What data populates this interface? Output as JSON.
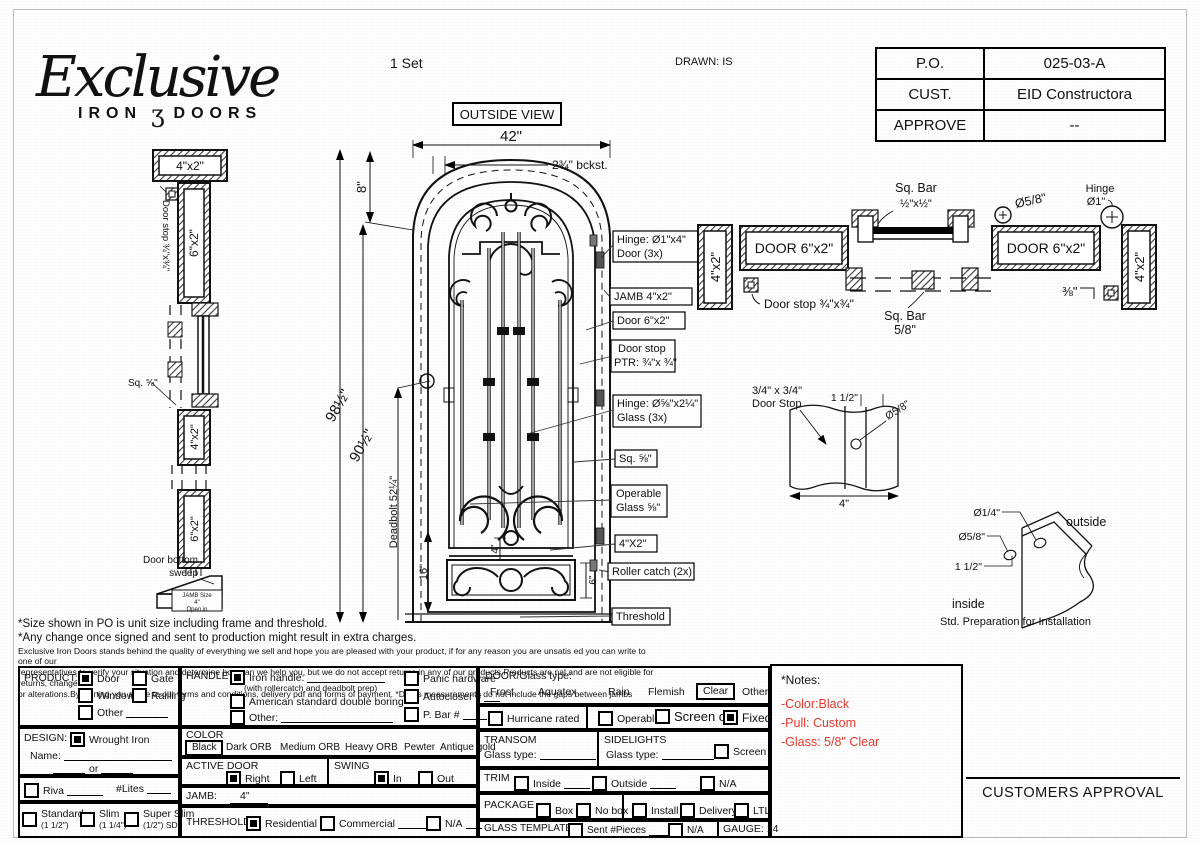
{
  "colors": {
    "accent_red": "#e8392e",
    "ink": "#111111"
  },
  "header": {
    "logo_script": "Exclusive",
    "logo_iron": "IRON",
    "logo_scroll": "ʒ",
    "logo_doors": "DOORS",
    "set_count": "1 Set",
    "drawn": "DRAWN: IS",
    "po_table": {
      "rows": [
        {
          "label": "P.O.",
          "value": "025-03-A"
        },
        {
          "label": "CUST.",
          "value": "EID Constructora"
        },
        {
          "label": "APPROVE",
          "value": "--"
        }
      ]
    }
  },
  "elevation": {
    "title": "OUTSIDE VIEW",
    "dim_width": "42\"",
    "dim_backset": "2¾\" bckst.",
    "dim_arch": "8\"",
    "dim_total": "98½\"",
    "dim_door": "90½\"",
    "dim_deadbolt": "Deadbolt 52¼\"",
    "dim_bottom": "16\"",
    "dim_gap": "4\"",
    "dim_panel": "6\"",
    "callouts": [
      {
        "l1": "Hinge: Ø1\"x4\"",
        "l2": "Door (3x)"
      },
      {
        "l1": "JAMB  4\"x2\"",
        "l2": ""
      },
      {
        "l1": "Door 6\"x2\"",
        "l2": ""
      },
      {
        "l1": "Door stop",
        "l2": "PTR: ¾\"x ¾\""
      },
      {
        "l1": "Hinge: Ø⅝\"x2¼\"",
        "l2": "Glass (3x)"
      },
      {
        "l1": "Sq. ⅝\"",
        "l2": ""
      },
      {
        "l1": "Operable",
        "l2": "Glass ⅝\""
      },
      {
        "l1": "4\"X2\"",
        "l2": ""
      },
      {
        "l1": "Roller catch  (2x)",
        "l2": ""
      },
      {
        "l1": "Threshold",
        "l2": ""
      }
    ]
  },
  "side_profile": {
    "top_box": "4\"x2\"",
    "door_stop": "Door stop ¾\"x¾\"",
    "upper_box": "6\"x2\"",
    "sq": "Sq. ⅝\"",
    "mid_box": "4\"x2\"",
    "lower_box": "6\"x2\"",
    "sweep1": "Door bottom",
    "sweep2": "sweep",
    "jamb1": "JAMB Size",
    "jamb2": "4\"",
    "jamb3": "Open in"
  },
  "plan": {
    "sqbar_top1": "Sq. Bar",
    "sqbar_top2": "½\"x½\"",
    "dia58": "Ø5/8\"",
    "hinge1": "Hinge",
    "hinge2": "Ø1\"",
    "door_left": "DOOR 6\"x2\"",
    "door_right": "DOOR 6\"x2\"",
    "jamb_left": "4\"x2\"",
    "jamb_right": "4\"x2\"",
    "door_stop": "Door stop ¾\"x¾\"",
    "sqbar_bot1": "Sq. Bar",
    "sqbar_bot2": "5/8\"",
    "dim38": "⅜\""
  },
  "stop_detail": {
    "l1": "3/4\" x 3/4\"",
    "l2": "Door Stop",
    "dim": "1 1/2\"",
    "dia": "Ø5/8\"",
    "width": "4\""
  },
  "install_detail": {
    "dia14": "Ø1/4\"",
    "dia58": "Ø5/8\"",
    "dim": "1 1/2\"",
    "outside": "outside",
    "inside": "inside",
    "caption": "Std. Preparation for Installation"
  },
  "disclaimer": {
    "line1": "*Size shown in PO is unit size including frame and threshold.",
    "line2": "*Any change once signed and sent to production might result in extra charges.",
    "line3": "Exclusive Iron Doors stands behind the quality of everything we sell and hope you are pleased with your product, if for any reason you are unsatis  ed you can write to one of our",
    "line4": "representatives to verify your situation and determine how can we help you, but we do not accept returns in any of our products.Products are   nal and are not eligible for returns, changes",
    "line5": "or alterations.By signing you agree to our terms and conditions, delivery pdf and forms of payment. *Doors measurements do not include the gaps between jambs"
  },
  "form": {
    "product": {
      "title": "PRODUCT:",
      "door": "Door",
      "gate": "Gate",
      "window": "Window",
      "railing": "Railling",
      "other": "Other"
    },
    "design": {
      "title": "DESIGN:",
      "wrought": "Wrought Iron",
      "name": "Name:",
      "or": "or",
      "riva": "Riva",
      "lites": "#Lites",
      "standard": "Standard",
      "standard_sub": "(1 1/2\")",
      "slim": "Slim",
      "slim_sub": "(1 1/4\")",
      "superslim": "Super Slim",
      "superslim_sub": "(1/2\") SDL"
    },
    "handle": {
      "title": "HANDLE",
      "iron": "Iron handle:",
      "iron_sub": "(with rollercatch and deadbolt prep)",
      "american": "American standard double boring",
      "other": "Other:",
      "panic": "Panic hardware",
      "autocloser": "Autocloser #",
      "pbar": "P. Bar #"
    },
    "color": {
      "title": "COLOR",
      "black": "Black",
      "dark": "Dark ORB",
      "medium": "Medium ORB",
      "heavy": "Heavy ORB",
      "pewter": "Pewter",
      "antique": "Antique gold"
    },
    "active": {
      "title": "ACTIVE DOOR",
      "right": "Right",
      "left": "Left"
    },
    "swing": {
      "title": "SWING",
      "in": "In",
      "out": "Out"
    },
    "jamb": {
      "title": "JAMB:",
      "value": "4\""
    },
    "threshold": {
      "title": "THRESHOLD",
      "residential": "Residential",
      "commercial": "Commercial",
      "na": "N/A"
    },
    "glass": {
      "title": "DOOR/Glass type:",
      "frost": "Frost",
      "aquatex": "Aquatex",
      "rain": "Rain",
      "flemish": "Flemish",
      "clear": "Clear",
      "other": "Other"
    },
    "hurricane": "Hurricane rated",
    "mode": {
      "operable": "Operable",
      "screen": "Screen or",
      "fixed": "Fixed"
    },
    "transom": {
      "title": "TRANSOM",
      "glass_type": "Glass type:"
    },
    "sidelights": {
      "title": "SIDELIGHTS",
      "glass_type": "Glass type:",
      "screen": "Screen"
    },
    "trim": {
      "title": "TRIM",
      "inside": "Inside",
      "outside": "Outside",
      "na": "N/A"
    },
    "package": {
      "title": "PACKAGE",
      "box": "Box",
      "nobox": "No box",
      "install": "Install",
      "delivery": "Delivery",
      "ltl": "LTL"
    },
    "template": {
      "title": "GLASS TEMPLATE",
      "sent": "Sent #Pieces",
      "na": "N/A",
      "gauge": "GAUGE: 14"
    },
    "checked": {
      "product": "Door",
      "design": "Wrought Iron",
      "handle": "Iron handle",
      "color": "Black",
      "active": "Right",
      "swing": "In",
      "threshold": "Residential",
      "glass": "Clear",
      "mode": "Fixed"
    }
  },
  "notes": {
    "title": "*Notes:",
    "lines": [
      "-Color:Black",
      "-Pull: Custom",
      "-Glass: 5/8\" Clear"
    ]
  },
  "approval": "CUSTOMERS APPROVAL"
}
